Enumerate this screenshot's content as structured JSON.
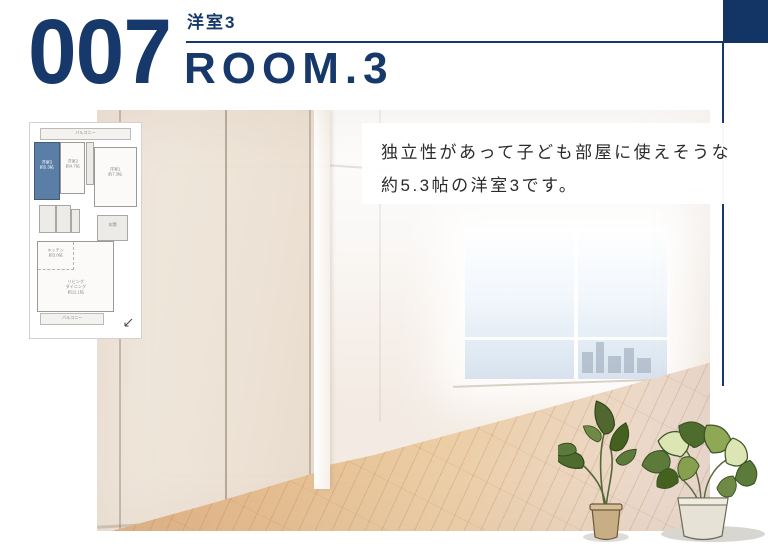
{
  "header": {
    "number": "007",
    "room_label": "洋室3",
    "room_title": "ROOM.3"
  },
  "caption": {
    "line1": "独立性があって子ども部屋に使えそうな",
    "line2": "約5.3帖の洋室3です。"
  },
  "floorplan": {
    "balcony_top": "バルコニー",
    "room3_name": "洋室3",
    "room3_size": "約5.3帖",
    "room2_name": "洋室2",
    "room2_size": "約4.7帖",
    "room1_name": "洋室1",
    "room1_size": "約7.3帖",
    "genkan": "玄関",
    "kitchen_name": "キッチン",
    "kitchen_size": "約3.0帖",
    "living_line1": "リビング",
    "living_line2": "ダイニング",
    "living_size": "約12.1帖",
    "balcony_bottom": "バルコニー"
  },
  "colors": {
    "navy": "#17386b",
    "room_highlight": "#5b7ea7",
    "floor_wood": "#e5bd90",
    "window_sky": "#dfe9f2"
  }
}
